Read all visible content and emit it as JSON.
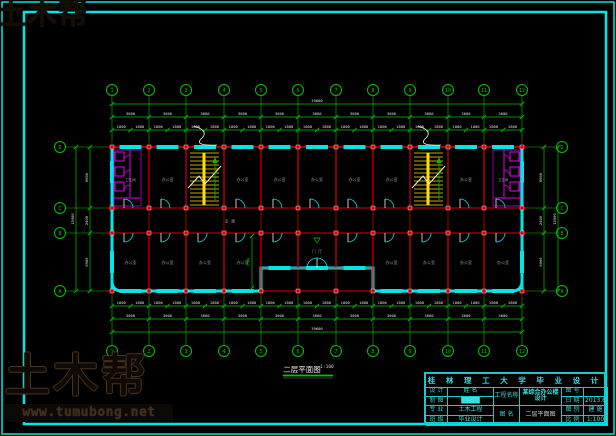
{
  "colors": {
    "cyan": "#00e6e6",
    "red": "#e00000",
    "green": "#00c300",
    "magenta": "#e500e5",
    "yellow": "#ffe000",
    "white": "#f2f2f2",
    "gray_text": "#8d9999",
    "dim_text": "#e0e0e0"
  },
  "watermark": {
    "brand": "土木帮",
    "url": "www.tumubong.net"
  },
  "caption": {
    "title": "二层平面图",
    "scale": "1:100"
  },
  "plan": {
    "col_labels": [
      "1",
      "2",
      "3",
      "4",
      "5",
      "6",
      "7",
      "8",
      "9",
      "10",
      "11",
      "12"
    ],
    "row_labels": [
      "D",
      "C",
      "B",
      "A"
    ],
    "dims": {
      "half": "1800",
      "bay": "3600",
      "overall_h": "39600",
      "rows": [
        "6600",
        "2400",
        "6900"
      ],
      "overall_v": "15900",
      "inner": "1500"
    },
    "room_labels": {
      "office": "办公室",
      "corridor": "走 廊",
      "toilet": "卫生间",
      "hall": "门 厅"
    }
  },
  "title_block": {
    "header": "桂 林 理 工 大 学 毕 业 设 计",
    "left_rows": [
      {
        "label": "设 计",
        "value": "姓 名"
      },
      {
        "label": "制 图",
        "value": "████"
      },
      {
        "label": "专 业",
        "value": "土木工程"
      },
      {
        "label": "班 级",
        "value": "毕业设计"
      }
    ],
    "project": {
      "label": "工程名称",
      "value": "某综合办公楼设计"
    },
    "drawing": {
      "label": "图 名",
      "value": "二层平面图"
    },
    "right_rows": [
      {
        "label": "图 号",
        "value": ""
      },
      {
        "label": "日 期",
        "value": "2013.6"
      },
      {
        "label": "图 别",
        "value": "建 施"
      },
      {
        "label": "比 例",
        "value": "1:100"
      }
    ]
  }
}
